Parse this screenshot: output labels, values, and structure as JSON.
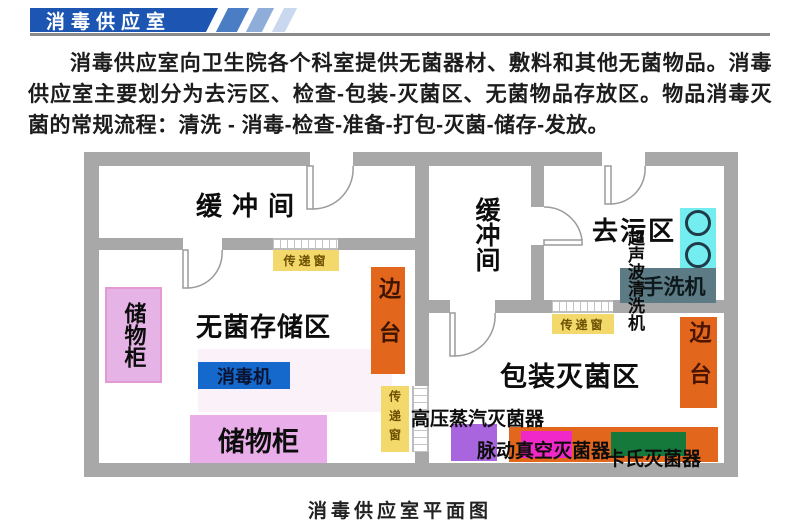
{
  "header": {
    "banner_title": "消毒供应室"
  },
  "intro_paragraph": "消毒供应室向卫生院各个科室提供无菌器材、敷料和其他无菌物品。消毒供应室主要划分为去污区、检查-包装-灭菌区、无菌物品存放区。物品消毒灭菌的常规流程：清洗 - 消毒-检查-准备-打包-灭菌-储存-发放。",
  "plan": {
    "rooms": {
      "buffer_left": "缓冲间",
      "buffer_middle": "缓冲间",
      "decontamination": "去污区",
      "sterile_storage": "无菌存储区",
      "packing_sterilization": "包装灭菌区"
    },
    "equipment": {
      "cabinet_left": "储物柜",
      "cabinet_bottom": "储物柜",
      "disinfector": "消毒机",
      "side_table_inner": "边台",
      "side_table_right": "边台",
      "pass_window_left": "传递窗",
      "pass_window_middle": "传递窗",
      "pass_window_right": "传递窗",
      "ultrasonic_cleaner": "超声波清洗机",
      "hand_washer": "手洗机",
      "steam_sterilizer": "高压蒸汽灭菌器",
      "pulse_vacuum_sterilizer": "脉动真空灭菌器",
      "cassette_sterilizer": "卡氏灭菌器"
    },
    "caption": "消毒供应室平面图"
  },
  "colors": {
    "banner_blue": "#1d55b2",
    "stripe_mid": "#4b7dc4",
    "stripe_light": "#8fadd9",
    "stripe_lighter": "#c9d8ee",
    "rule_gray": "#8a8a8a",
    "wall_gray": "#a8a8a8",
    "cabinet_pink": "#e6b3e6",
    "disinfector_blue": "#1569cc",
    "side_table_orange": "#e2661c",
    "pass_window_yellow": "#f3d96b",
    "sink_cyan": "#74edf0",
    "hand_washer_slate": "#5c7b84",
    "sterilizer_purple": "#a965dd",
    "sterilizer_magenta": "#f128c8",
    "cassette_green": "#15793b"
  }
}
